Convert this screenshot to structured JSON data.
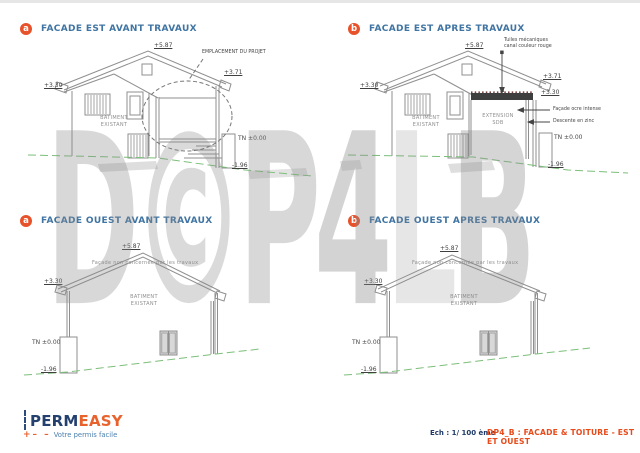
{
  "colors": {
    "accent_orange": "#e8522a",
    "heading_blue": "#3f74a3",
    "logo_navy": "#24406f",
    "logo_orange": "#e8622d",
    "ground_green": "#7cbf7a",
    "watermark_gray": "#8c8c8c",
    "sheet_title_orange": "#e84a1a"
  },
  "watermark": {
    "letters": [
      "D",
      "©",
      "P",
      "4",
      "L",
      "B"
    ]
  },
  "panels": [
    {
      "badge": "a",
      "title": "FACADE EST AVANT TRAVAUX",
      "labels": {
        "ridge": "+5.87",
        "left_eave": "+3.30",
        "right_eave": "+3.71",
        "project": "EMPLACEMENT DU PROJET",
        "building_line1": "BATIMENT",
        "building_line2": "EXISTANT",
        "tn": "TN ±0.00",
        "low": "-1.96"
      }
    },
    {
      "badge": "b",
      "title": "FACADE EST APRES TRAVAUX",
      "labels": {
        "ridge": "+5.87",
        "left_eave": "+3.30",
        "right_top": "+3.71",
        "right_eave": "+3.30",
        "tiles_line1": "Tuiles mécaniques",
        "tiles_line2": "canal couleur rouge",
        "building_line1": "BATIMENT",
        "building_line2": "EXISTANT",
        "extension_line1": "EXTENSION",
        "extension_line2": "SDB",
        "facade_note": "Façade ocre intense",
        "downpipe_note": "Descente en zinc",
        "tn": "TN ±0.00",
        "low": "-1.96"
      }
    },
    {
      "badge": "a",
      "title": "FACADE OUEST AVANT TRAVAUX",
      "labels": {
        "ridge": "+5.87",
        "left_eave": "+3.30",
        "note": "Façade non concernée par les travaux",
        "building_line1": "BATIMENT",
        "building_line2": "EXISTANT",
        "tn": "TN ±0.00",
        "low": "-1.96"
      }
    },
    {
      "badge": "b",
      "title": "FACADE OUEST APRES TRAVAUX",
      "labels": {
        "ridge": "+5.87",
        "left_eave": "+3.30",
        "note": "Façade non concernée par les travaux",
        "building_line1": "BATIMENT",
        "building_line2": "EXISTANT",
        "tn": "TN ±0.00",
        "low": "-1.96"
      }
    }
  ],
  "footer": {
    "logo": {
      "part1": "PERM",
      "part2": "EASY",
      "plus": "+",
      "dashes": "– –",
      "tagline": "Votre permis facile"
    },
    "scale": "Ech : 1/ 100 ème",
    "sheet": "DP4_B : FACADE & TOITURE - EST ET OUEST"
  }
}
